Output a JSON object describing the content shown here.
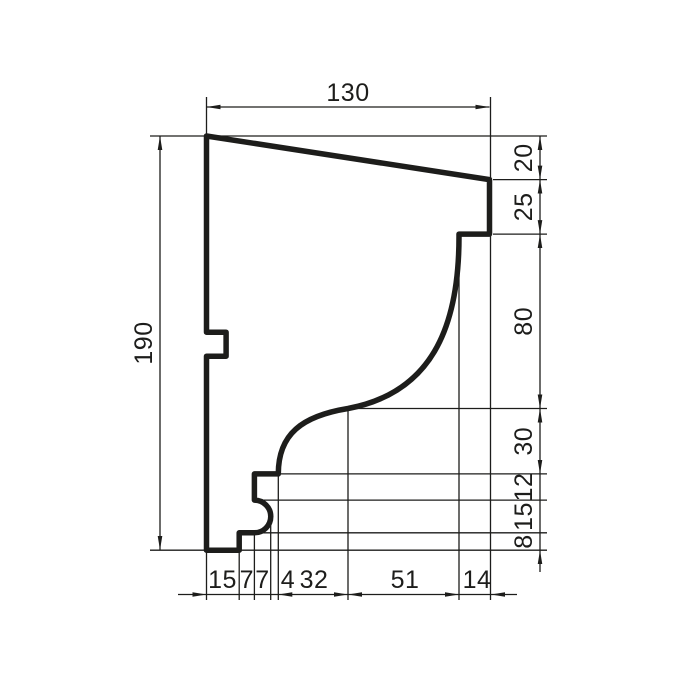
{
  "drawing": {
    "type": "technical-profile-drawing",
    "subject": "cornice-molding-cross-section",
    "background_color": "#ffffff",
    "line_color": "#1d1d1b",
    "dims": {
      "top": "130",
      "left": "190",
      "right": [
        "20",
        "25",
        "80",
        "30",
        "12",
        "15",
        "8"
      ],
      "bottom": [
        "15",
        "7",
        "7",
        "4",
        "32",
        "51",
        "14"
      ]
    }
  }
}
